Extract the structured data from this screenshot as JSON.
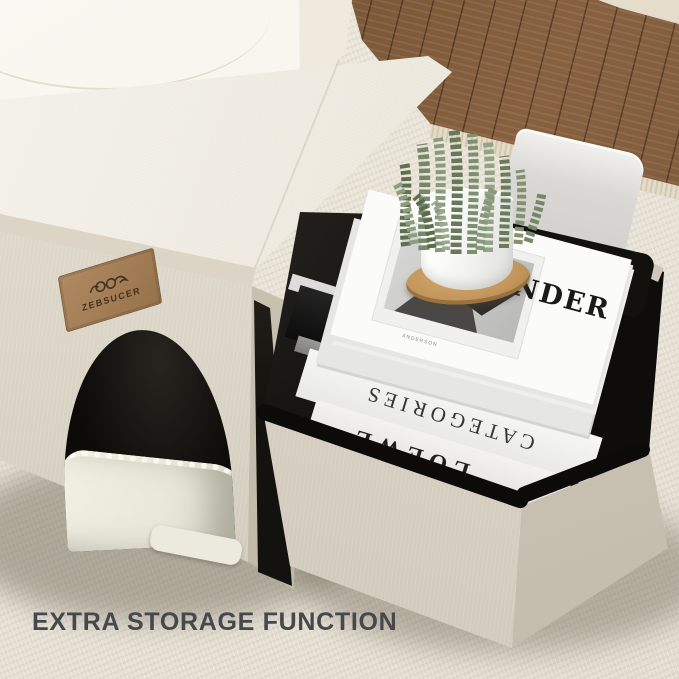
{
  "page": {
    "type": "product-lifestyle-photo",
    "subject": "fabric pet house ottoman with open storage compartment"
  },
  "caption": {
    "text": "EXTRA STORAGE FUNCTION",
    "color": "#45494d"
  },
  "patch": {
    "brand": "ZEBSUCER",
    "logo": "cat-with-glasses",
    "leather_color": "#a5805a"
  },
  "books": {
    "top": {
      "title_visible": "NDER",
      "small_caption": "ANDERSON"
    },
    "glace": {
      "title": "Glacé",
      "author_small": "Herve Wetzel"
    },
    "categories": {
      "title": "CATEGORIES"
    },
    "loewe": {
      "title": "LOEWE"
    }
  },
  "objects": {
    "pet_house": "beige fabric pet house ottoman with arched door, plush pad and leather brand patch",
    "storage_box": "open storage ottoman with black binding trim holding stacked books",
    "open_lid": "light grey open lid leaning at back right",
    "plant": "jade-necklace succulent in glossy white pot on round bamboo coaster",
    "background": "cream sofa, brown wood floor, beige woven rug with fringe"
  },
  "colors": {
    "rug": "#e9e4d7",
    "wood_floor": "#7a5a3c",
    "sofa": "#f7f4ec",
    "house_fabric": "#e3ded2",
    "house_fabric_dark": "#cdc6b6",
    "box_interior": "#0e0d0b",
    "binding_trim": "#0c0b0a",
    "pot": "#f4f4f2",
    "coaster": "#c2955e",
    "plant_green": "#74875f",
    "caption_text": "#45494d"
  }
}
